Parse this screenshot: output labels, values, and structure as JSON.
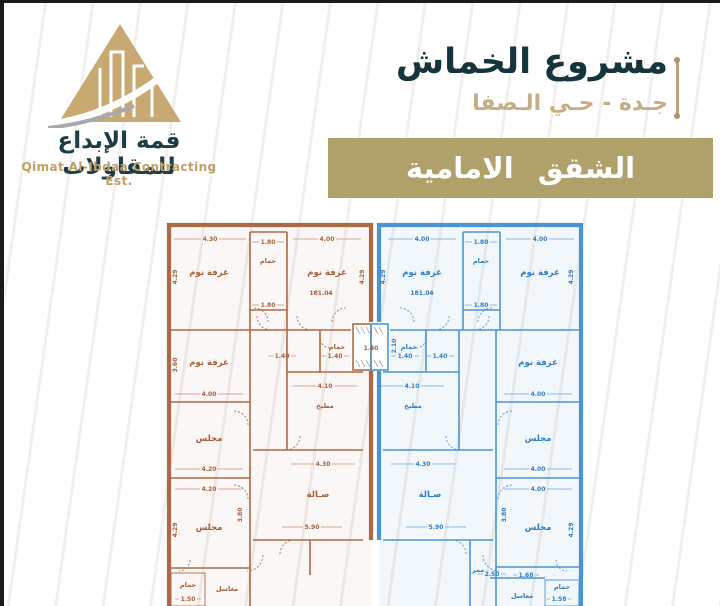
{
  "logo": {
    "name_ar": "قمة الإبداع للمقاولات",
    "name_en": "Qimat Al-Ibdaa Contracting Est."
  },
  "header": {
    "project_title": "مشروع الخماش",
    "location": "جـدة - حـي الـصفا",
    "banner_label": "الشقق الامامية"
  },
  "plan": {
    "unit_area": "181.04",
    "rooms": {
      "bedroom": "غرفة نوم",
      "bathroom": "حمام",
      "kitchen": "مطبخ",
      "hall": "صـالة",
      "majlis": "مجلس",
      "laundry": "مغاسل",
      "corridor": "ممر"
    },
    "dims": {
      "d430": "4.30",
      "d400": "4.00",
      "d410": "4.10",
      "d420": "4.20",
      "d429": "4.29",
      "d360": "3.60",
      "d380": "3.80",
      "d210": "2.10",
      "d590": "5.90",
      "d180": "1.80",
      "d140": "1.40",
      "d150": "1.50",
      "d158": "1.58",
      "d168": "1.68",
      "d250": "2.50"
    }
  },
  "colors": {
    "gold": "#c9a972",
    "teal": "#1d3c45",
    "banner": "#b0a069",
    "left_unit": "#ab6a45",
    "right_unit": "#4b94d4"
  }
}
